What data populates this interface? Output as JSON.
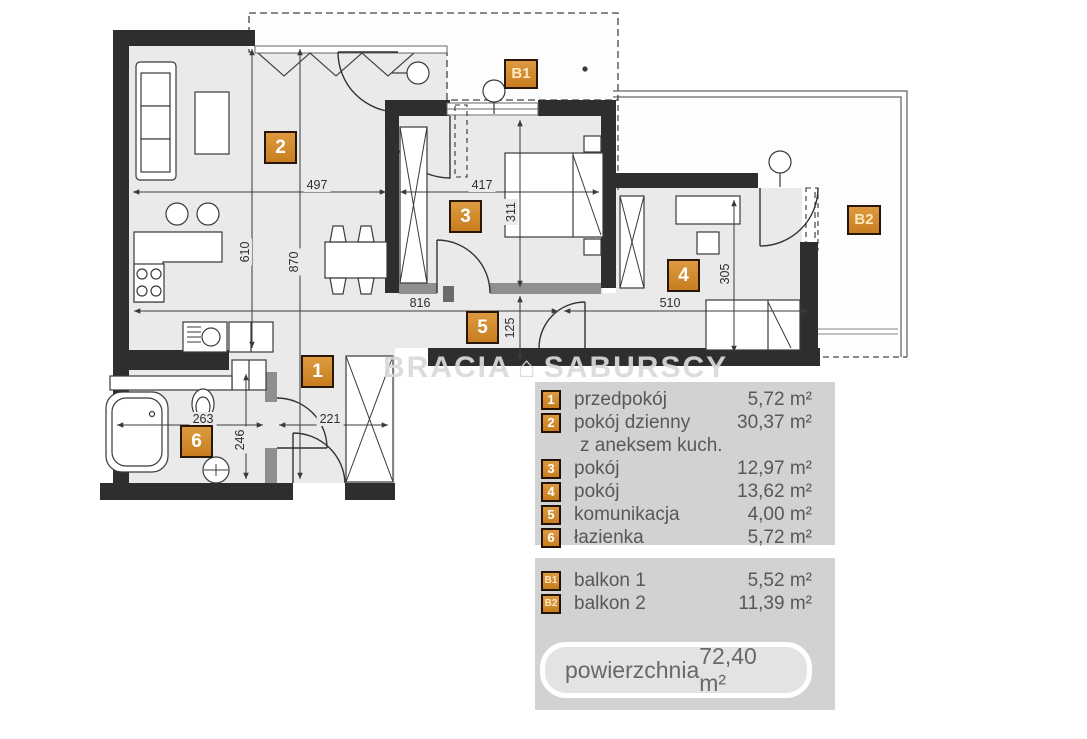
{
  "watermark": {
    "part1": "BRACIA",
    "logo_glyph": "⌂",
    "part2": "SABURSCY"
  },
  "plan": {
    "room_markers": [
      {
        "id": "1"
      },
      {
        "id": "2"
      },
      {
        "id": "3"
      },
      {
        "id": "4"
      },
      {
        "id": "5"
      },
      {
        "id": "6"
      },
      {
        "id": "B1"
      },
      {
        "id": "B2"
      }
    ],
    "dimensions_cm": [
      {
        "value": "497"
      },
      {
        "value": "417"
      },
      {
        "value": "610"
      },
      {
        "value": "870"
      },
      {
        "value": "311"
      },
      {
        "value": "816"
      },
      {
        "value": "510"
      },
      {
        "value": "125"
      },
      {
        "value": "305"
      },
      {
        "value": "263"
      },
      {
        "value": "221"
      },
      {
        "value": "246"
      }
    ]
  },
  "legend": {
    "rooms": [
      {
        "id": "1",
        "name": "przedpokój",
        "area": "5,72 m²"
      },
      {
        "id": "2",
        "name": "pokój dzienny",
        "name_line2": "z aneksem kuch.",
        "area": "30,37 m²"
      },
      {
        "id": "3",
        "name": "pokój",
        "area": "12,97 m²"
      },
      {
        "id": "4",
        "name": "pokój",
        "area": "13,62 m²"
      },
      {
        "id": "5",
        "name": "komunikacja",
        "area": "4,00 m²"
      },
      {
        "id": "6",
        "name": "łazienka",
        "area": "5,72 m²"
      }
    ],
    "balconies": [
      {
        "id": "B1",
        "name": "balkon 1",
        "area": "5,52 m²"
      },
      {
        "id": "B2",
        "name": "balkon 2",
        "area": "11,39 m²"
      }
    ],
    "total": {
      "label": "powierzchnia",
      "value": "72,40 m²"
    }
  },
  "colors": {
    "wall": "#2e2e2e",
    "floor": "#eaeaea",
    "marker_orange": "#d0882e",
    "legend_panel": "#d2d2d2"
  }
}
